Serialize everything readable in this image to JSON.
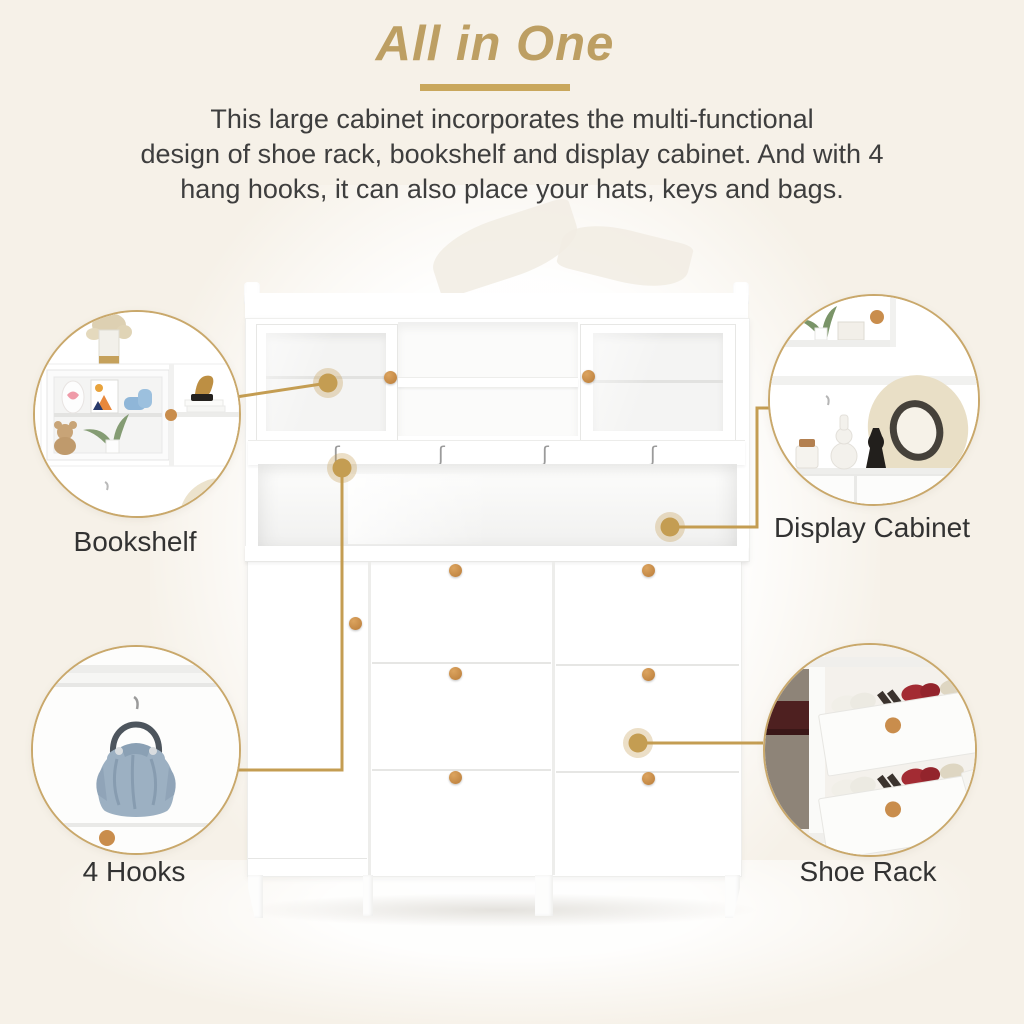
{
  "page": {
    "background_color": "#f6f1e8",
    "title_gold": "#bd9f63",
    "callout_gold": "#c49d52",
    "circle_border_gold": "#c9a86b",
    "text_color": "#3e3e3e",
    "knob_wood_color": "#c98d4c"
  },
  "header": {
    "title": "All in One",
    "description_lines": [
      "This large cabinet incorporates the multi-functional",
      "design of shoe rack, bookshelf and display cabinet. And with 4",
      "hang hooks, it can also place your hats, keys and bags."
    ]
  },
  "features": [
    {
      "id": "bookshelf",
      "label": "Bookshelf"
    },
    {
      "id": "display-cabinet",
      "label": "Display Cabinet"
    },
    {
      "id": "hooks",
      "label": "4 Hooks"
    },
    {
      "id": "shoe-rack",
      "label": "Shoe Rack"
    }
  ],
  "icons": {
    "s_hook": "ʃ"
  }
}
